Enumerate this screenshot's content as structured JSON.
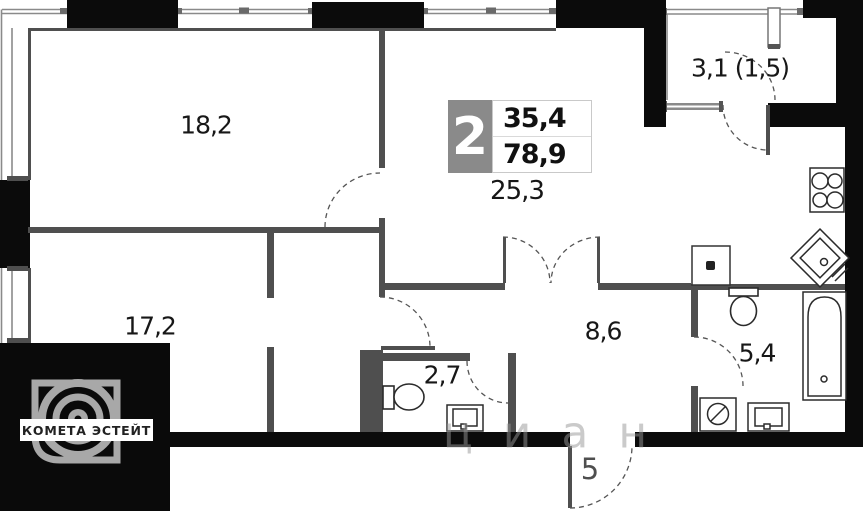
{
  "floor_plan": {
    "badge": {
      "rooms_count": "2",
      "area_upper": "35,4",
      "area_lower": "78,9",
      "area_living": "25,3"
    },
    "labels": {
      "bedroom_top": "18,2",
      "bedroom_left": "17,2",
      "kitchen_living": "25,3",
      "hallway": "8,6",
      "wc": "2,7",
      "bathroom": "5,4",
      "balcony": "3,1 (1,5)",
      "entrance": "5"
    },
    "colors": {
      "wall_gray": "#4f4f4f",
      "structure_black": "#0b0b0b",
      "badge_gray": "#8a8a8a",
      "window_line": "#8a8a8a"
    },
    "icons": [
      "stove-icon",
      "kitchen-sink-icon",
      "toilet-icon",
      "bathtub-icon",
      "washing-machine-icon",
      "basin-icon",
      "vent-shaft-icon"
    ]
  },
  "branding": {
    "agency": "КОМЕТА ЭСТЕЙТ"
  },
  "watermark": {
    "text": "циан"
  }
}
